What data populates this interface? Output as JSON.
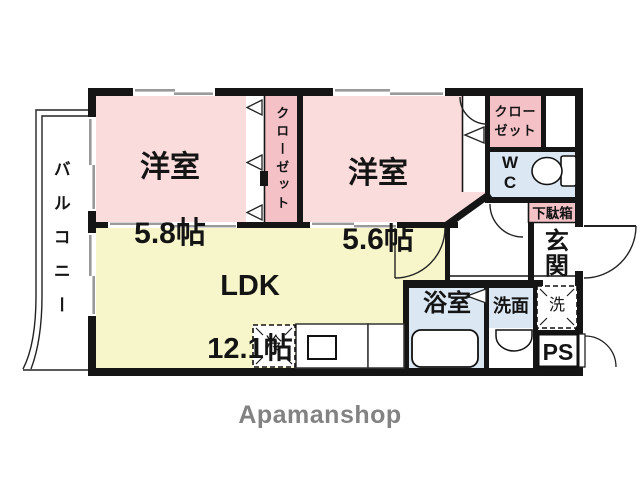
{
  "colors": {
    "wall": "#151515",
    "room_pink": "#fadcdc",
    "closet_pink": "#f4c1c7",
    "water_blue": "#dbe7f3",
    "ldk_yellow": "#f7f5ca",
    "window_gray": "#9a9a9a",
    "logo_gray": "#828282",
    "line": "#222222"
  },
  "rooms": {
    "room1": {
      "name": "洋室",
      "size": "5.8帖"
    },
    "room2": {
      "name": "洋室",
      "size": "5.6帖"
    },
    "ldk": {
      "name": "LDK",
      "size": "12.1帖"
    }
  },
  "labels": {
    "balcony": "バルコニー",
    "closet_strip": "クローゼット",
    "closet_box": "クロー\nゼット",
    "wc": "W\nC",
    "shoe_cabinet": "下駄箱",
    "entrance": "玄関",
    "fridge": "冷",
    "bathroom": "浴室",
    "washroom": "洗面",
    "washer": "洗",
    "pipe_space": "PS",
    "brand": "Apamanshop"
  },
  "icons": {
    "toilet": "toilet-icon",
    "bathtub": "bathtub-icon",
    "washbasin": "washbasin-icon",
    "kitchen_sink": "kitchen-sink-icon",
    "door_swing": "door-swing-arc",
    "folding_door": "folding-door-triangle",
    "sliding_window": "sliding-window-band"
  }
}
